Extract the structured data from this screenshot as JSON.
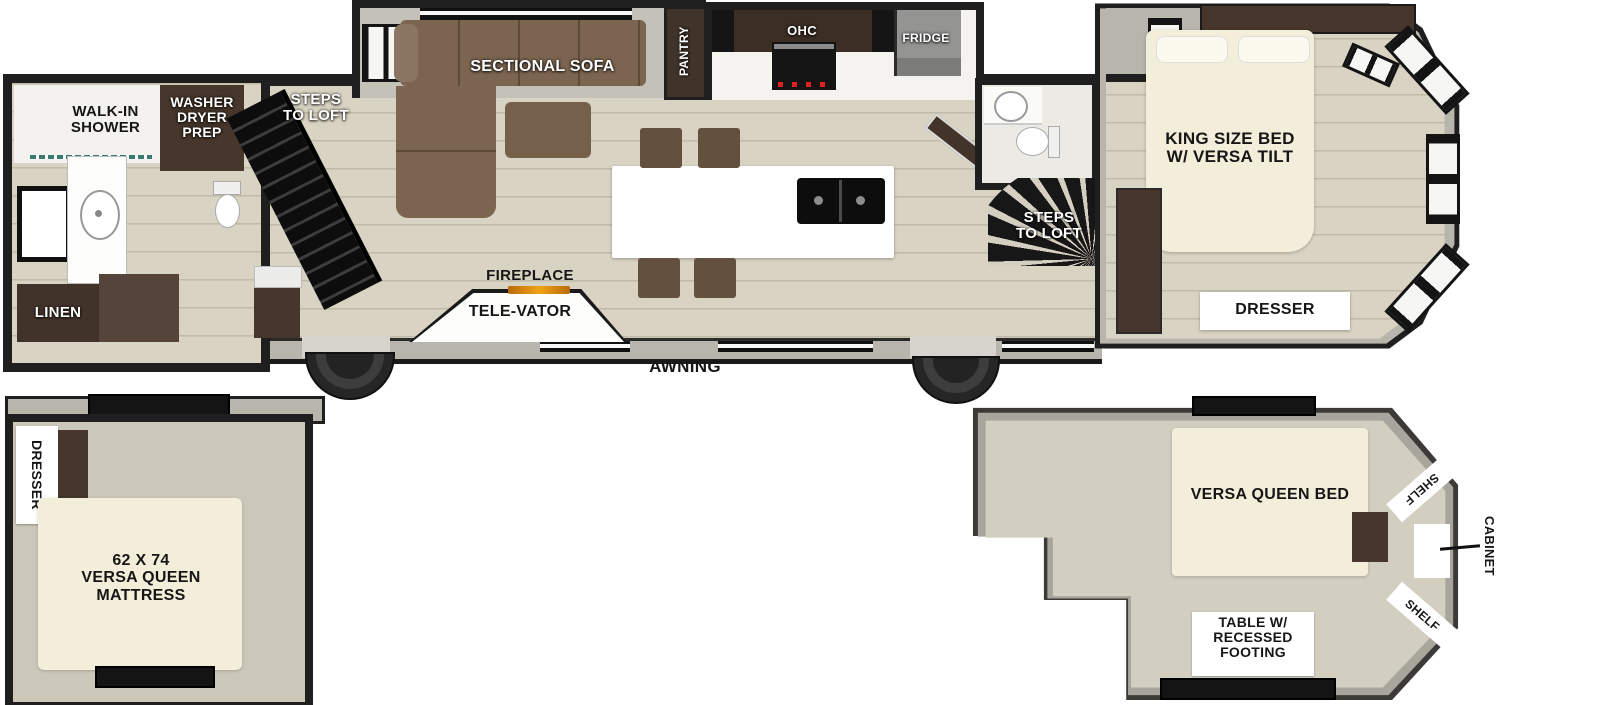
{
  "plan": {
    "bath": {
      "shower": "WALK-IN\nSHOWER",
      "washer": "WASHER\nDRYER\nPREP",
      "linen": "LINEN"
    },
    "living": {
      "steps_rear": "STEPS\nTO LOFT",
      "sofa": "SECTIONAL SOFA",
      "pantry": "PANTRY",
      "ohc": "OHC",
      "fridge": "FRIDGE",
      "fireplace": "FIREPLACE",
      "televator": "TELE-VATOR",
      "steps_front": "STEPS\nTO LOFT",
      "awning": "AWNING"
    },
    "bedroom": {
      "bed": "KING SIZE BED\nW/ VERSA TILT",
      "dresser": "DRESSER"
    }
  },
  "loft_left": {
    "dresser": "DRESSER",
    "mattress": "62 X 74\nVERSA QUEEN\nMATTRESS"
  },
  "loft_right": {
    "bed": "VERSA QUEEN BED",
    "shelf_top": "SHELF",
    "shelf_bottom": "SHELF",
    "cabinet": "CABINET",
    "table": "TABLE W/\nRECESSED\nFOOTING"
  },
  "colors": {
    "wall": "#1f1f1f",
    "floor": "#d8d3c2",
    "cabinet_dark": "#46362b",
    "sofa_brown": "#7b6550",
    "bed_cream": "#f3eeda",
    "exterior_gray": "#b8b5ac",
    "fridge_gray": "#90908e",
    "flame_orange": "#e8900e"
  }
}
